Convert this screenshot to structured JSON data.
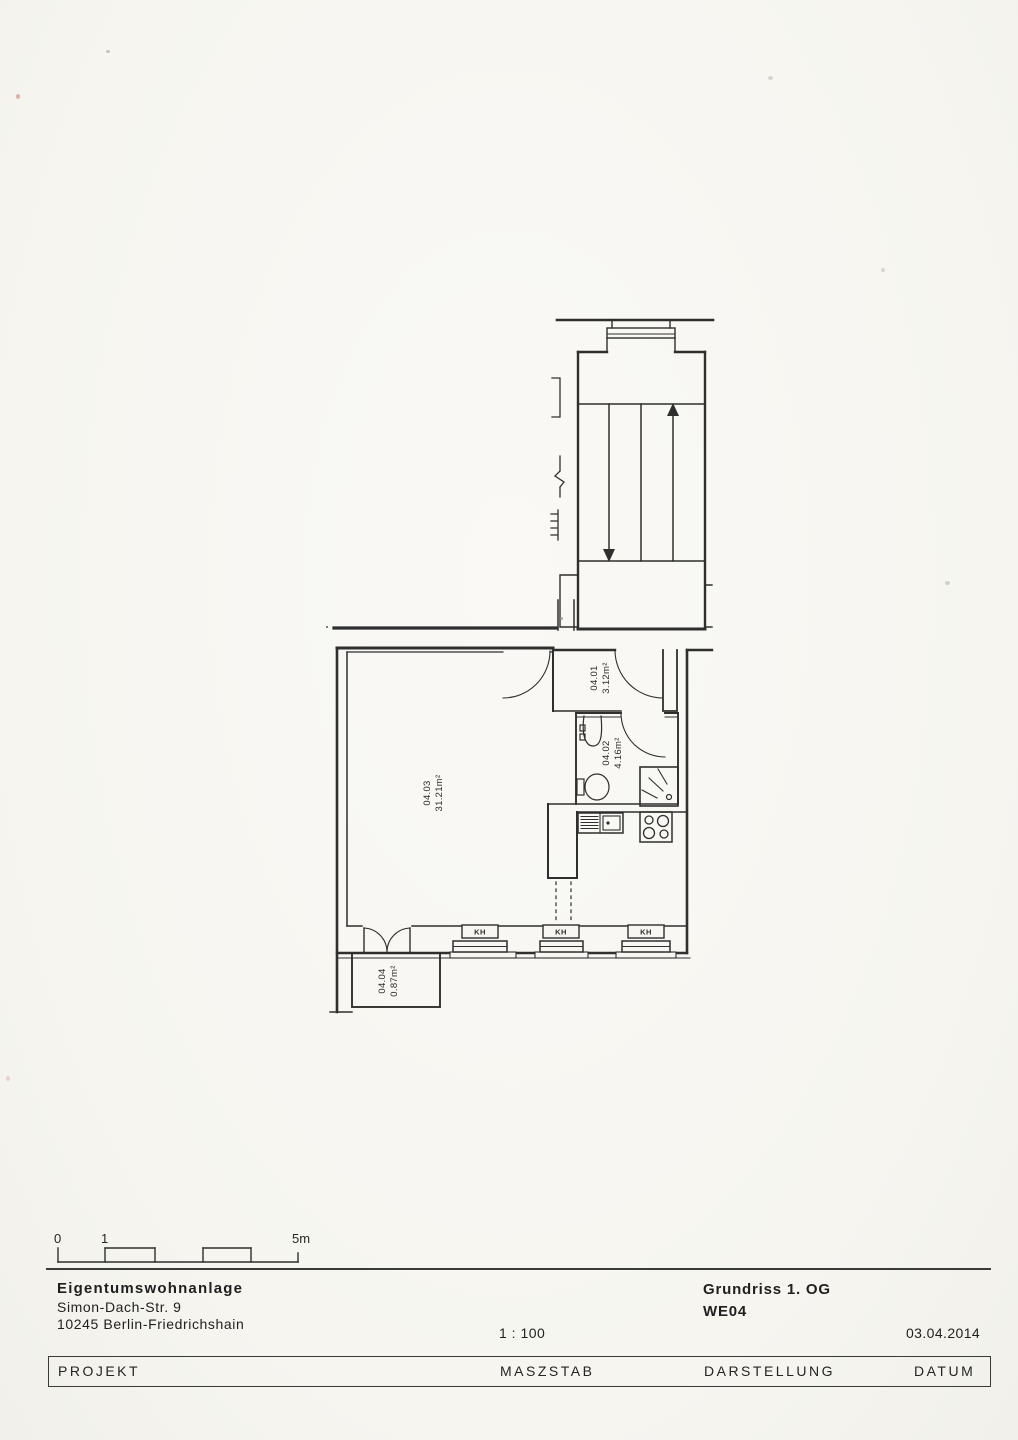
{
  "page": {
    "scale_bar": {
      "tick_0": "0",
      "tick_1": "1",
      "tick_5": "5m"
    },
    "plan": {
      "rooms": [
        {
          "id": "04.01",
          "area": "3.12m²"
        },
        {
          "id": "04.02",
          "area": "4.16m²"
        },
        {
          "id": "04.03",
          "area": "31.21m²"
        },
        {
          "id": "04.04",
          "area": "0.87m²"
        }
      ],
      "window_marker": "KH"
    },
    "title_block": {
      "project_name": "Eigentumswohnanlage",
      "project_address_line1": "Simon-Dach-Str. 9",
      "project_address_line2": "10245 Berlin-Friedrichshain",
      "scale_value": "1 : 100",
      "drawing_title": "Grundriss 1. OG",
      "drawing_unit": "WE04",
      "date_value": "03.04.2014",
      "labels": {
        "project": "PROJEKT",
        "scale": "MASZSTAB",
        "representation": "DARSTELLUNG",
        "date": "DATUM"
      }
    },
    "colors": {
      "paper": "#f7f6f2",
      "ink": "#2f2f2f"
    }
  }
}
